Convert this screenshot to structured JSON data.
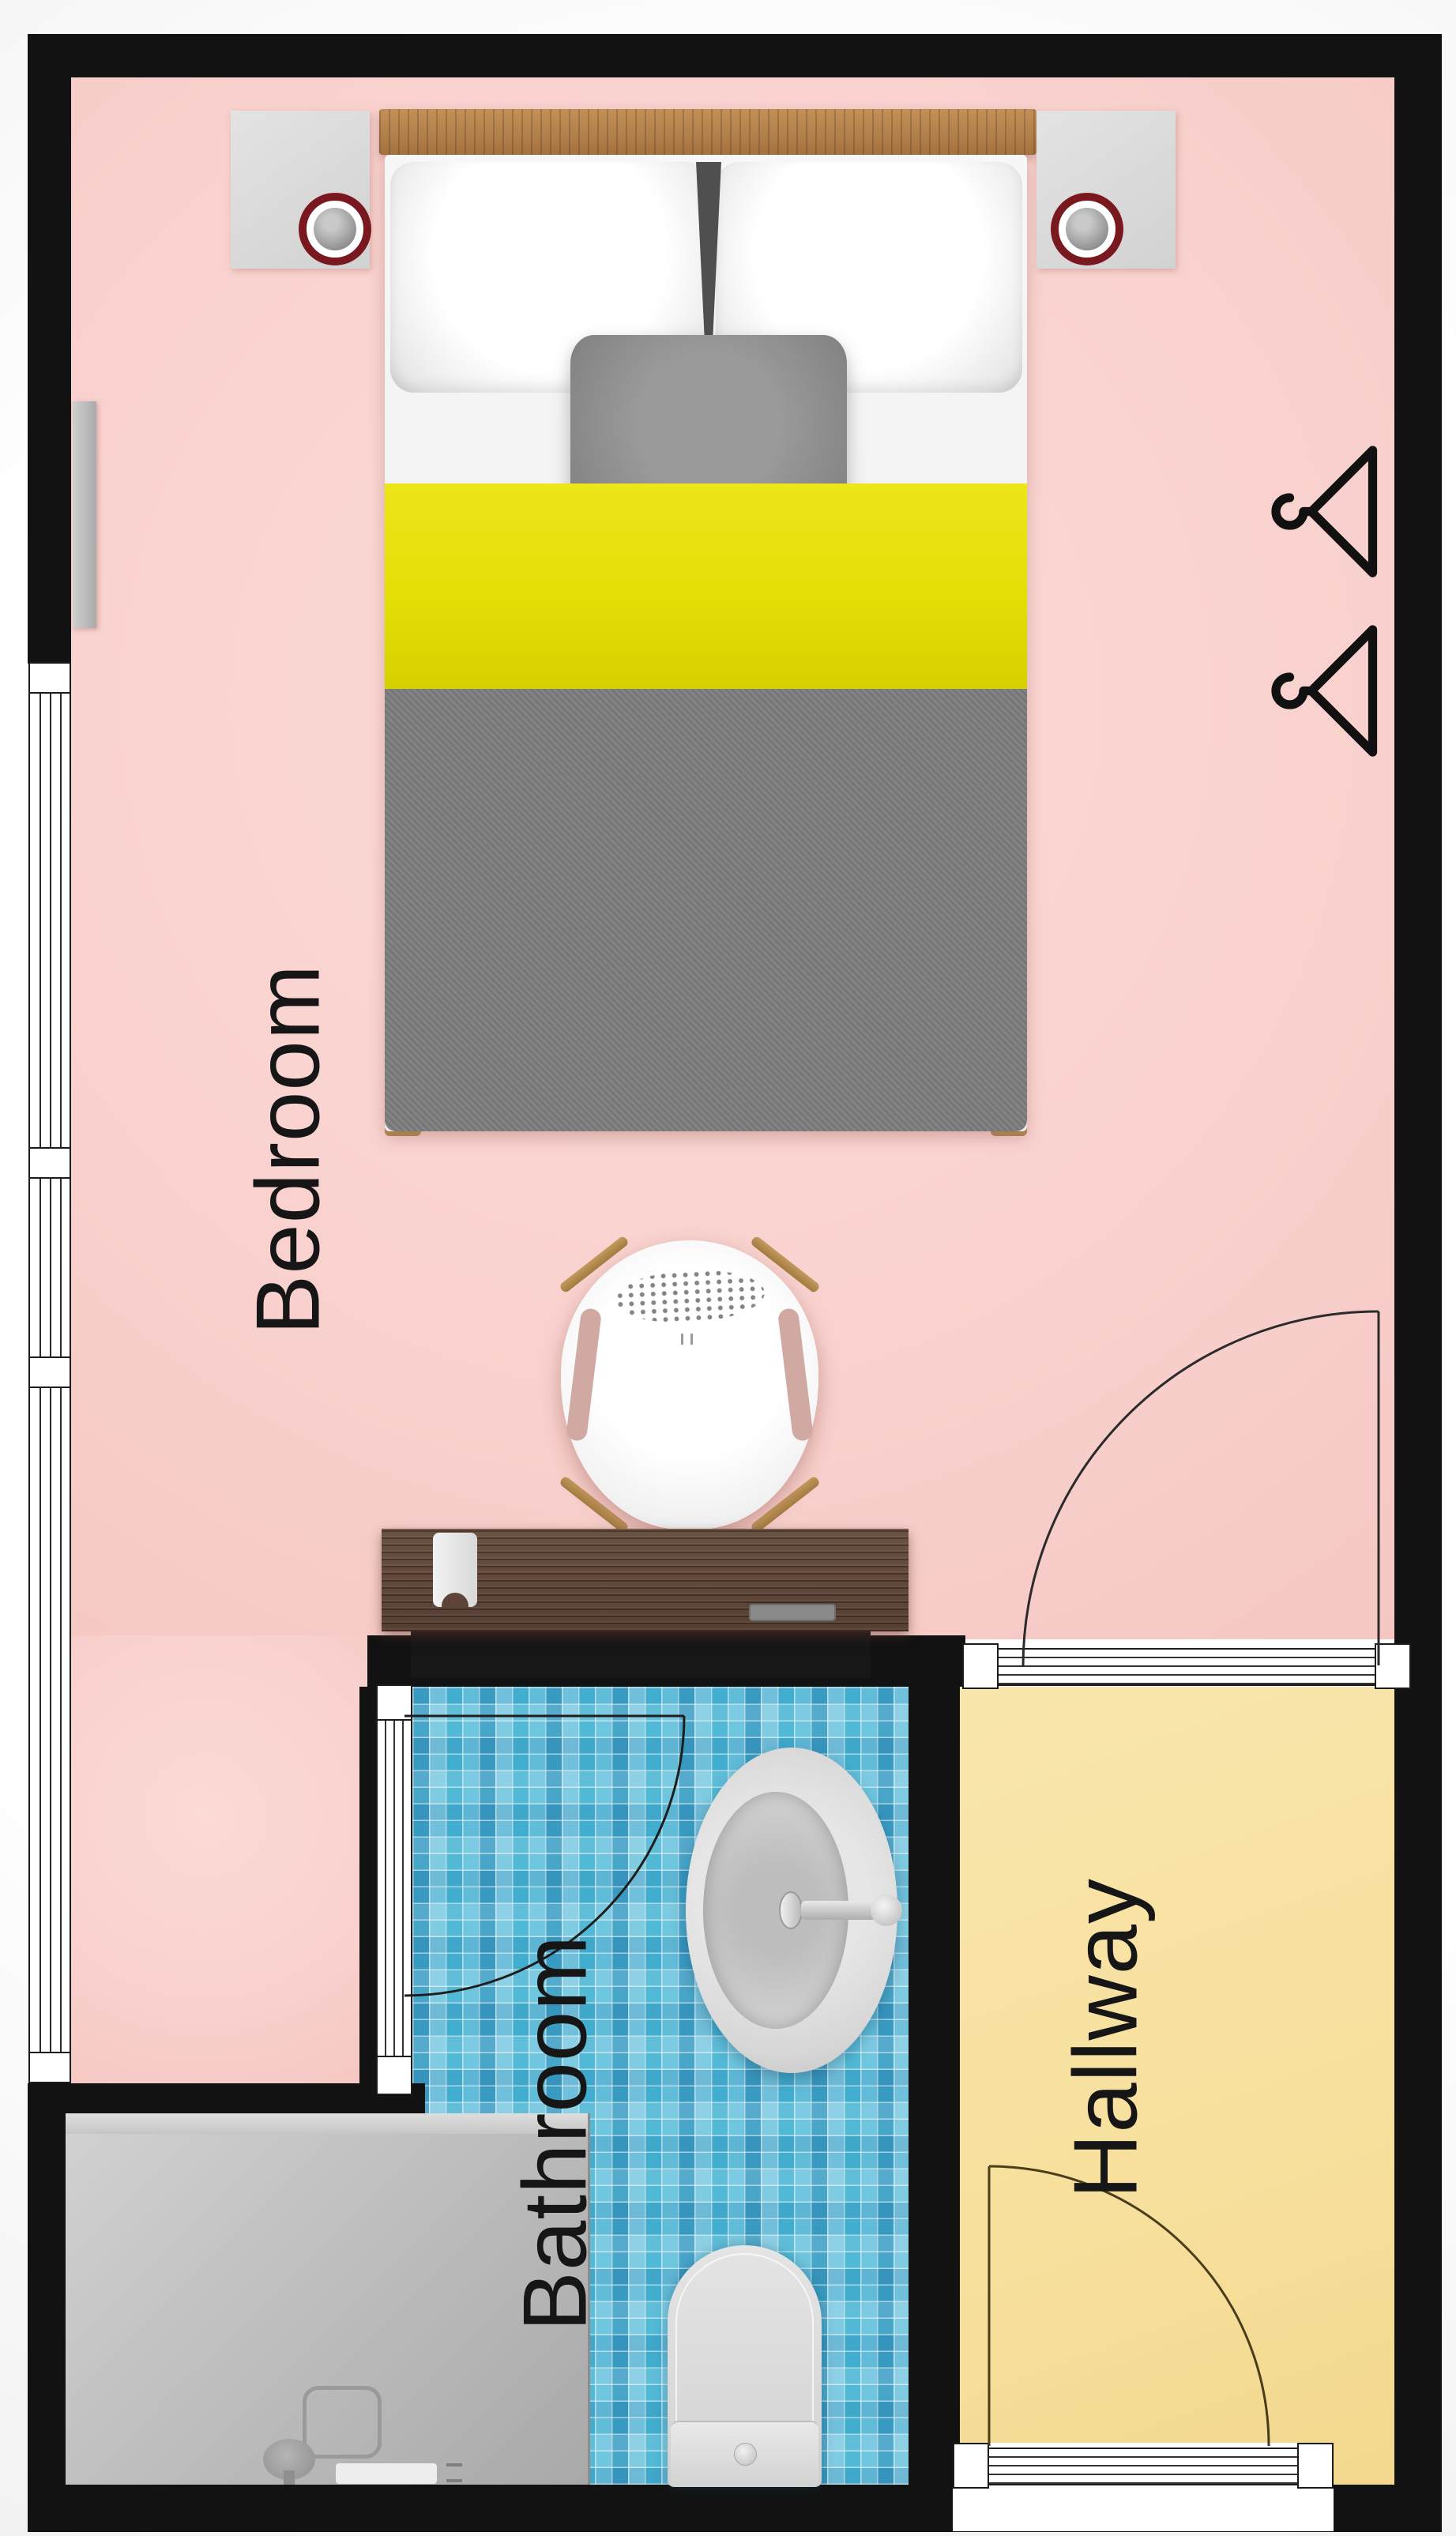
{
  "plan": {
    "type": "apartment-floor-plan",
    "rooms": [
      {
        "id": "bedroom",
        "label": "Bedroom",
        "floor_color": "#f9d2cf"
      },
      {
        "id": "bathroom",
        "label": "Bathroom",
        "floor_color": "#4ab0d3"
      },
      {
        "id": "hallway",
        "label": "Hallway",
        "floor_color": "#f8e3a4"
      }
    ],
    "palette": {
      "wall": "#121212",
      "window_frame": "#ffffff",
      "wood_headboard": "#b2854f",
      "wood_desk": "#5a4236",
      "bed_sheet": "#f2f2f2",
      "bed_yellow": "#e7e112",
      "bed_blanket": "#7b7b7b",
      "pillow_gray": "#8f8f8f",
      "tile_blue": "#53b8d8",
      "shower_gray": "#bdbdbd",
      "fixture_white": "#dcdcdc",
      "lamp_ring_red": "#7a1820",
      "hanger_black": "#111111",
      "door_arc": "#2b2b2b"
    },
    "furniture": [
      "double-bed",
      "nightstand-left",
      "nightstand-right",
      "bedside-lamp-left",
      "bedside-lamp-right",
      "wall-shelf",
      "clothes-hanger-top",
      "clothes-hanger-bottom",
      "chair",
      "desk",
      "bathroom-sink",
      "toilet",
      "walk-in-shower"
    ],
    "openings": [
      "left-window",
      "bedroom-hallway-door",
      "bathroom-door",
      "entrance-door"
    ]
  }
}
